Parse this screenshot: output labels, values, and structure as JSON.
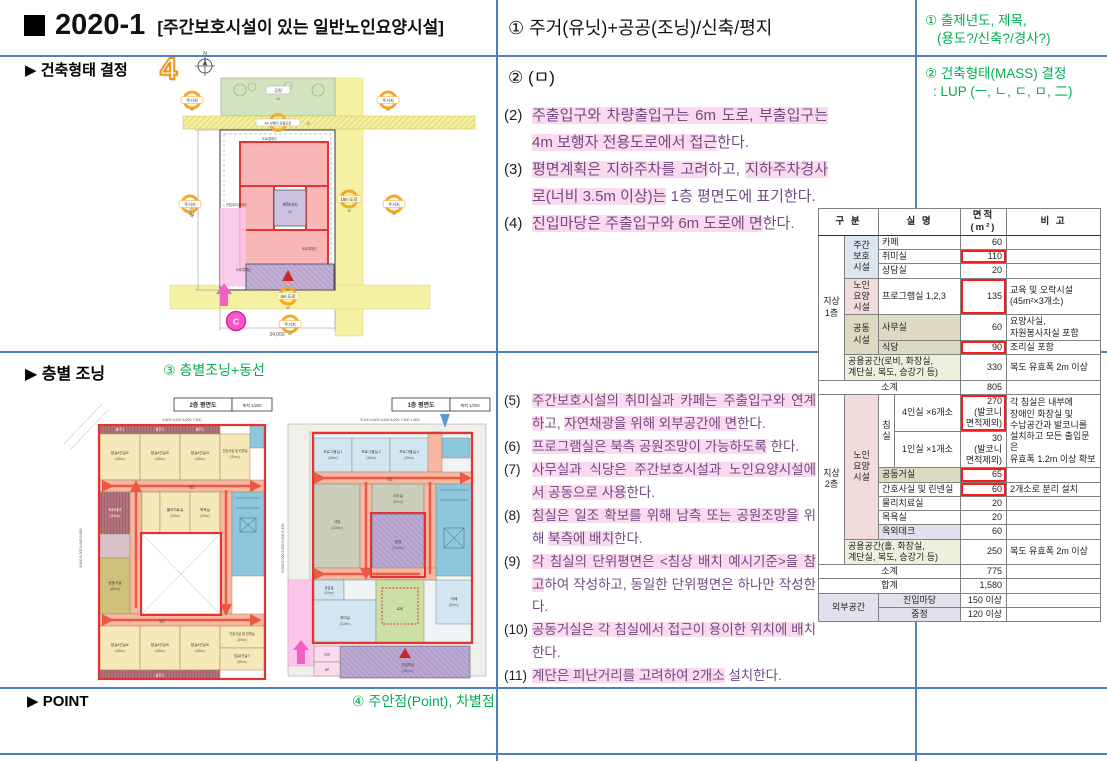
{
  "title": {
    "year": "2020-1",
    "subtitle": "[주간보호시설이 있는 일반노인요양시설]"
  },
  "cells": {
    "middle1": "① 주거(유닛)+공공(조닝)/신축/평지",
    "middle2": "② (ㅁ)"
  },
  "green": {
    "g1a": "① 출제년도, 제목,",
    "g1b": "(용도?/신축?/경사?)",
    "g2a": "② 건축형태(MASS) 결정",
    "g2b": ": LUP (ㅡ, ㄴ, ㄷ, ㅁ, 二)",
    "g3": "③ 층별조닝+동선",
    "g4": "④ 주안점(Point), 차별점"
  },
  "sections": {
    "s2": "▶ 건축형태 결정",
    "s3": "▶ 층별 조닝",
    "s4": "▶ POINT",
    "badge4": "4"
  },
  "notes2": [
    {
      "no": "(2)",
      "segs": [
        {
          "t": "주출입구와 차량출입구는 6m 도로, 부출입구는 4m 보행자 전용도로에서 접근",
          "h": 1
        },
        {
          "t": "한다.",
          "h": 0
        }
      ]
    },
    {
      "no": "(3)",
      "segs": [
        {
          "t": "평면계획은 지하주차를 고려",
          "h": 1
        },
        {
          "t": "하고, ",
          "h": 0
        },
        {
          "t": "지하주차경사로(너비 3.5m 이상)는",
          "h": 1
        },
        {
          "t": " 1층 평면도에 표기한다.",
          "h": 0
        }
      ]
    },
    {
      "no": "(4)",
      "segs": [
        {
          "t": "진입마당은 주출입구와 6m 도로에 면",
          "h": 1
        },
        {
          "t": "한다.",
          "h": 0
        }
      ]
    }
  ],
  "notes3": [
    {
      "no": "(5)",
      "segs": [
        {
          "t": "주간보호시설의 취미실과 카페는 주출입구와 연계하",
          "h": 1
        },
        {
          "t": "고, ",
          "h": 0
        },
        {
          "t": "자연채광을 위해 외부공간에 면",
          "h": 1
        },
        {
          "t": "한다.",
          "h": 0
        }
      ]
    },
    {
      "no": "(6)",
      "segs": [
        {
          "t": "프로그램실은 북측 공원조망이 가능하도록",
          "h": 1
        },
        {
          "t": " 한다.",
          "h": 0
        }
      ]
    },
    {
      "no": "(7)",
      "segs": [
        {
          "t": "사무실과 식당은 주간보호시설과 노인요양시설에서 공동으로 사용",
          "h": 1
        },
        {
          "t": "한다.",
          "h": 0
        }
      ]
    },
    {
      "no": "(8)",
      "segs": [
        {
          "t": "침실은 일조 확보를 위해 남측 또는 공원조망을",
          "h": 1
        },
        {
          "t": " 위해 ",
          "h": 0
        },
        {
          "t": "북측에 배치",
          "h": 1
        },
        {
          "t": "한다.",
          "h": 0
        }
      ]
    },
    {
      "no": "(9)",
      "segs": [
        {
          "t": "각 침실의 단위평면은 <침상 배치 예시기준>을 참고",
          "h": 1
        },
        {
          "t": "하여 작성하고, 동일한 단위평면은 하나만 작성한다.",
          "h": 0
        }
      ]
    },
    {
      "no": "(10)",
      "segs": [
        {
          "t": "공동거실은 각 침실에서 접근이 용이한 위치에 배",
          "h": 1
        },
        {
          "t": "치한다.",
          "h": 0
        }
      ]
    },
    {
      "no": "(11)",
      "segs": [
        {
          "t": "계단은 피난거리를 고려하여 2개소",
          "h": 1
        },
        {
          "t": " 설치한다.",
          "h": 0
        }
      ]
    }
  ],
  "site": {
    "residential": "주거지",
    "park": "공원",
    "road4": "4m 보행자 전용도로",
    "road10": "10m 도로",
    "road6": "6m 도로",
    "site_label": "계획대지",
    "level": "±0",
    "boundary_road": "도로경계선",
    "boundary_adj": "인접대지경계선",
    "dim_h": "48,000",
    "dim_w": "34,000",
    "c_marker": "C",
    "north": "N"
  },
  "f2": {
    "title": "2층 평면도",
    "scale": "축척 1/200",
    "dims_top": "6,600        6,600        6,600        7,500",
    "dims_left": "6,600      6,000      6,600      6,600",
    "balcony": "발코니",
    "corridor": "복도",
    "b1": "침실4인실①",
    "b2": "침실4인실②",
    "b3": "침실4인실③",
    "b4": "침실4인실④",
    "b5": "침실4인실⑤",
    "b6": "침실4인실⑥",
    "a45": "(45m²)",
    "nurse": "간호사실 및 린넨실",
    "a30": "(30m²)",
    "deck": "옥외데크",
    "a60": "(60m²)",
    "physio": "물리치료실",
    "a20": "(20m²)",
    "bath": "목욕실",
    "living": "공동거실",
    "a65": "(65m²)",
    "single1": "침실1인실①"
  },
  "f1": {
    "title": "1층 평면도",
    "scale": "축척 1/200",
    "dims_top": "5,200     6,600     6,600     6,600     7,500   1,500",
    "dims_left": "6,600     6,000     6,600     6,600     6,400",
    "corridor": "복도",
    "p1": "프로그램실 1",
    "p2": "프로그램실 2",
    "p3": "프로그램실 3",
    "a45": "(45m²)",
    "office": "사무실",
    "a60": "(60m²)",
    "dining": "식당",
    "a120": "(120m²)",
    "court": "중정",
    "counsel": "상담실",
    "a20": "(20m²)",
    "hobby": "취미실",
    "a110": "(110m²)",
    "lobby": "로비",
    "cafe": "카페",
    "yard": "진입마당",
    "a150": "(150m²)",
    "parking": "주차",
    "hp": "HP"
  },
  "table": {
    "rows": [
      {
        "cells": [
          {
            "t": "구 분",
            "c": 2,
            "cls": "c hd"
          },
          {
            "t": "실 명",
            "c": 2,
            "cls": "c hd"
          },
          {
            "t": "면적(m²)",
            "cls": "c hd"
          },
          {
            "t": "비 고",
            "cls": "c hd"
          }
        ]
      },
      {
        "cells": [
          {
            "t": "지상\n1층",
            "r": 7,
            "cls": "c"
          },
          {
            "t": "주간\n보호\n시설",
            "r": 3,
            "cls": "c bg-blue"
          },
          {
            "t": "카페",
            "c": 2,
            "cls": "l"
          },
          {
            "t": "60",
            "cls": "r"
          },
          {
            "t": "",
            "cls": "l"
          }
        ]
      },
      {
        "cells": [
          {
            "t": "취미실",
            "c": 2,
            "cls": "l"
          },
          {
            "t": "110",
            "cls": "r",
            "red": 1
          },
          {
            "t": "",
            "cls": "l"
          }
        ]
      },
      {
        "cells": [
          {
            "t": "상담실",
            "c": 2,
            "cls": "l"
          },
          {
            "t": "20",
            "cls": "r"
          },
          {
            "t": "",
            "cls": "l"
          }
        ]
      },
      {
        "cells": [
          {
            "t": "노인\n요양\n시설",
            "cls": "c bg-pink"
          },
          {
            "t": "프로그램실 1,2,3",
            "c": 2,
            "cls": "l"
          },
          {
            "t": "135",
            "cls": "r",
            "red": 1
          },
          {
            "t": "교육 및 오락시설\n(45m²×3개소)",
            "cls": "l"
          }
        ]
      },
      {
        "cells": [
          {
            "t": "공동\n시설",
            "r": 2,
            "cls": "c bg-tan"
          },
          {
            "t": "사무실",
            "c": 2,
            "cls": "l bg-tan"
          },
          {
            "t": "60",
            "cls": "r"
          },
          {
            "t": "요양사실,\n자원봉사자실 포함",
            "cls": "l"
          }
        ]
      },
      {
        "cells": [
          {
            "t": "식당",
            "c": 2,
            "cls": "l bg-tan"
          },
          {
            "t": "90",
            "cls": "r",
            "red": 1
          },
          {
            "t": "조리실 포함",
            "cls": "l"
          }
        ]
      },
      {
        "cells": [
          {
            "t": "공용공간(로비, 화장실,\n계단실, 복도, 승강기 등)",
            "c": 3,
            "cls": "l bg-grn"
          },
          {
            "t": "330",
            "cls": "r"
          },
          {
            "t": "복도 유효폭 2m 이상",
            "cls": "l"
          }
        ]
      },
      {
        "cells": [
          {
            "t": "소계",
            "c": 4,
            "cls": "c"
          },
          {
            "t": "805",
            "cls": "r"
          },
          {
            "t": "",
            "cls": "l"
          }
        ]
      },
      {
        "tt": 1,
        "cells": [
          {
            "t": "지상\n2층",
            "r": 8,
            "cls": "c"
          },
          {
            "t": "노인\n요양\n시설",
            "r": 7,
            "cls": "c bg-pink"
          },
          {
            "t": "침\n실",
            "r": 2,
            "cls": "c"
          },
          {
            "t": "4인실 ×6개소",
            "cls": "c"
          },
          {
            "t": "270\n(발코니\n면적제외)",
            "cls": "r",
            "red": 1
          },
          {
            "t": "각 침실은 내부에\n장애인 화장실 및\n수납공간과 발코니를\n설치하고 모든 출입문은\n유효폭 1.2m 이상 확보",
            "r": 2,
            "cls": "l"
          }
        ]
      },
      {
        "cells": [
          {
            "t": "1인실 ×1개소",
            "cls": "c"
          },
          {
            "t": "30\n(발코니\n면적제외)",
            "cls": "r"
          }
        ]
      },
      {
        "cells": [
          {
            "t": "공동거실",
            "c": 2,
            "cls": "l bg-tan"
          },
          {
            "t": "65",
            "cls": "r",
            "red": 1
          },
          {
            "t": "",
            "cls": "l"
          }
        ]
      },
      {
        "cells": [
          {
            "t": "간호사실 및 린넨실",
            "c": 2,
            "cls": "l"
          },
          {
            "t": "60",
            "cls": "r",
            "red": 1
          },
          {
            "t": "2개소로 분리 설치",
            "cls": "l"
          }
        ]
      },
      {
        "cells": [
          {
            "t": "물리치료실",
            "c": 2,
            "cls": "l"
          },
          {
            "t": "20",
            "cls": "r"
          },
          {
            "t": "",
            "cls": "l"
          }
        ]
      },
      {
        "cells": [
          {
            "t": "목욕실",
            "c": 2,
            "cls": "l"
          },
          {
            "t": "20",
            "cls": "r"
          },
          {
            "t": "",
            "cls": "l"
          }
        ]
      },
      {
        "cells": [
          {
            "t": "옥외데크",
            "c": 2,
            "cls": "l bg-lav"
          },
          {
            "t": "60",
            "cls": "r"
          },
          {
            "t": "",
            "cls": "l"
          }
        ]
      },
      {
        "cells": [
          {
            "t": "공용공간(홀, 화장실,\n계단실, 복도, 승강기 등)",
            "c": 3,
            "cls": "l bg-grn"
          },
          {
            "t": "250",
            "cls": "r"
          },
          {
            "t": "복도 유효폭 2m 이상",
            "cls": "l"
          }
        ]
      },
      {
        "cells": [
          {
            "t": "소계",
            "c": 4,
            "cls": "c"
          },
          {
            "t": "775",
            "cls": "r"
          },
          {
            "t": "",
            "cls": "l"
          }
        ]
      },
      {
        "cells": [
          {
            "t": "합계",
            "c": 4,
            "cls": "c"
          },
          {
            "t": "1,580",
            "cls": "r"
          },
          {
            "t": "",
            "cls": "l"
          }
        ]
      },
      {
        "tt": 1,
        "cells": [
          {
            "t": "외부공간",
            "c": 2,
            "r": 2,
            "cls": "c bg-lav"
          },
          {
            "t": "진입마당",
            "c": 2,
            "cls": "c bg-lav"
          },
          {
            "t": "150 이상",
            "cls": "r"
          },
          {
            "t": "",
            "cls": "l"
          }
        ]
      },
      {
        "cells": [
          {
            "t": "중정",
            "c": 2,
            "cls": "c bg-lav"
          },
          {
            "t": "120 이상",
            "cls": "r"
          },
          {
            "t": "",
            "cls": "l"
          }
        ]
      }
    ]
  }
}
